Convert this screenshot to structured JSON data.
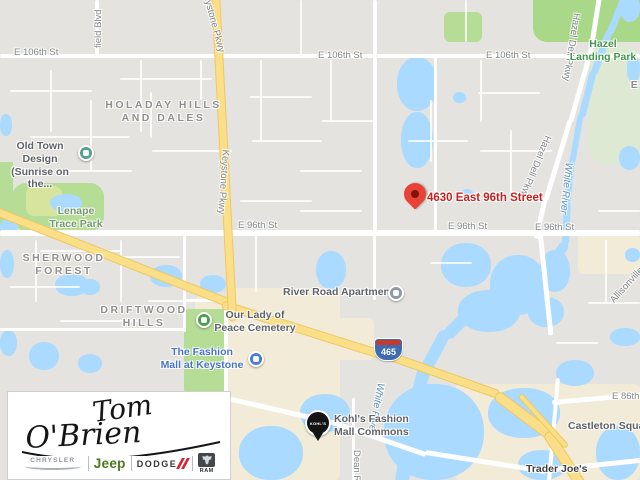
{
  "map": {
    "pin": {
      "label": "4630 East 96th Street"
    },
    "shield_text": "465",
    "pois": {
      "old_town": {
        "label": "Old Town Design\n(Sunrise on the..."
      },
      "river_road": {
        "label": "River Road Apartments"
      },
      "our_lady": {
        "label": "Our Lady of\nPeace Cemetery"
      },
      "fashion_mall": {
        "label": "The Fashion\nMall at Keystone"
      },
      "kohls": {
        "label": "Kohl's Fashion\nMall Commons",
        "badge": "KOHL'S"
      },
      "castleton": {
        "label": "Castleton Square"
      },
      "trader_joes": {
        "label": "Trader Joe's"
      }
    },
    "labels": [
      {
        "name": "label-e-106th-st-left",
        "kind": "street",
        "text": "E 106th St",
        "x": 14,
        "y": 47
      },
      {
        "name": "label-e-106th-st-mid",
        "kind": "street",
        "text": "E 106th St",
        "x": 318,
        "y": 50
      },
      {
        "name": "label-e-106th-st-right",
        "kind": "street",
        "text": "E 106th St",
        "x": 486,
        "y": 50
      },
      {
        "name": "label-e-96th-st-left",
        "kind": "street",
        "text": "E 96th St",
        "x": 238,
        "y": 220
      },
      {
        "name": "label-e-96th-st-mid",
        "kind": "street",
        "text": "E 96th St",
        "x": 448,
        "y": 221
      },
      {
        "name": "label-e-96th-st-right",
        "kind": "street",
        "text": "E 96th St",
        "x": 535,
        "y": 222
      },
      {
        "name": "label-e-86th-st",
        "kind": "street",
        "text": "E 86th St",
        "x": 612,
        "y": 391
      },
      {
        "name": "label-keystone-pkwy-top",
        "kind": "street",
        "text": "Keystone Pkwy",
        "x": 210,
        "y": -12,
        "rot": 75
      },
      {
        "name": "label-keystone-pkwy",
        "kind": "street",
        "text": "Keystone Pkwy",
        "x": 231,
        "y": 150,
        "rot": 94
      },
      {
        "name": "label-hazel-dell-pkwy-top",
        "kind": "street",
        "text": "Hazel Dell Pkwy",
        "x": 582,
        "y": 14,
        "rot": 99
      },
      {
        "name": "label-hazel-dell-pkwy",
        "kind": "street",
        "text": "Hazel Dell Pkwy",
        "x": 553,
        "y": 138,
        "rot": 113
      },
      {
        "name": "label-field-blvd",
        "kind": "street",
        "text": "field Blvd",
        "x": 93,
        "y": 48,
        "rot": -90
      },
      {
        "name": "label-dean-rd",
        "kind": "street",
        "text": "Dean Rd",
        "x": 362,
        "y": 450,
        "rot": 90
      },
      {
        "name": "label-allisonville-rd",
        "kind": "street",
        "text": "Allisonville Rd",
        "x": 608,
        "y": 298,
        "rot": -48
      },
      {
        "name": "label-holaday-hills-and-dales",
        "kind": "hood",
        "text": "HOLADAY HILLS\nAND DALES",
        "x": 86,
        "y": 99,
        "w": 155
      },
      {
        "name": "label-sherwood-forest",
        "kind": "hood",
        "text": "SHERWOOD\nFOREST",
        "x": 16,
        "y": 252,
        "w": 96
      },
      {
        "name": "label-driftwood-hills",
        "kind": "hood",
        "text": "DRIFTWOOD\nHILLS",
        "x": 92,
        "y": 304,
        "w": 104
      },
      {
        "name": "label-el",
        "kind": "hood",
        "text": "EL",
        "x": 620,
        "y": 79,
        "w": 40
      },
      {
        "name": "label-hazel-landing-park",
        "kind": "park",
        "text": "Hazel\nLanding Park",
        "x": 548,
        "y": 38,
        "w": 110
      },
      {
        "name": "label-lenape-trace-park",
        "kind": "park2",
        "text": "Lenape\nTrace Park",
        "x": 40,
        "y": 205,
        "w": 72
      },
      {
        "name": "label-white-river-top",
        "kind": "water",
        "text": "White River",
        "x": 574,
        "y": 163,
        "rot": 96
      },
      {
        "name": "label-white-river",
        "kind": "water",
        "text": "White River",
        "x": 386,
        "y": 384,
        "rot": 101
      }
    ]
  },
  "logo": {
    "script_line1": "Tom",
    "script_line2": "O'Brien",
    "brands": {
      "chrysler": "CHRYSLER",
      "jeep": "Jeep",
      "dodge": "DODGE",
      "ram": "RAM"
    }
  },
  "colors": {
    "land": "#e5e3df",
    "water": "#aadaff",
    "park": "#b5dd96",
    "park_bright": "#a9d889",
    "commercial": "#f1ebd7",
    "road": "#ffffff",
    "highway": "#fbdf88",
    "highway_border": "#eec863",
    "pin_red": "#ea4335",
    "address_red": "#c5221f",
    "poi_gray": "#5f6368",
    "poi_blue": "#4a73c9",
    "park_label": "#41984e",
    "water_label": "#5d92c1",
    "jeep_green": "#4b7a1f",
    "dodge_red": "#d22730"
  }
}
